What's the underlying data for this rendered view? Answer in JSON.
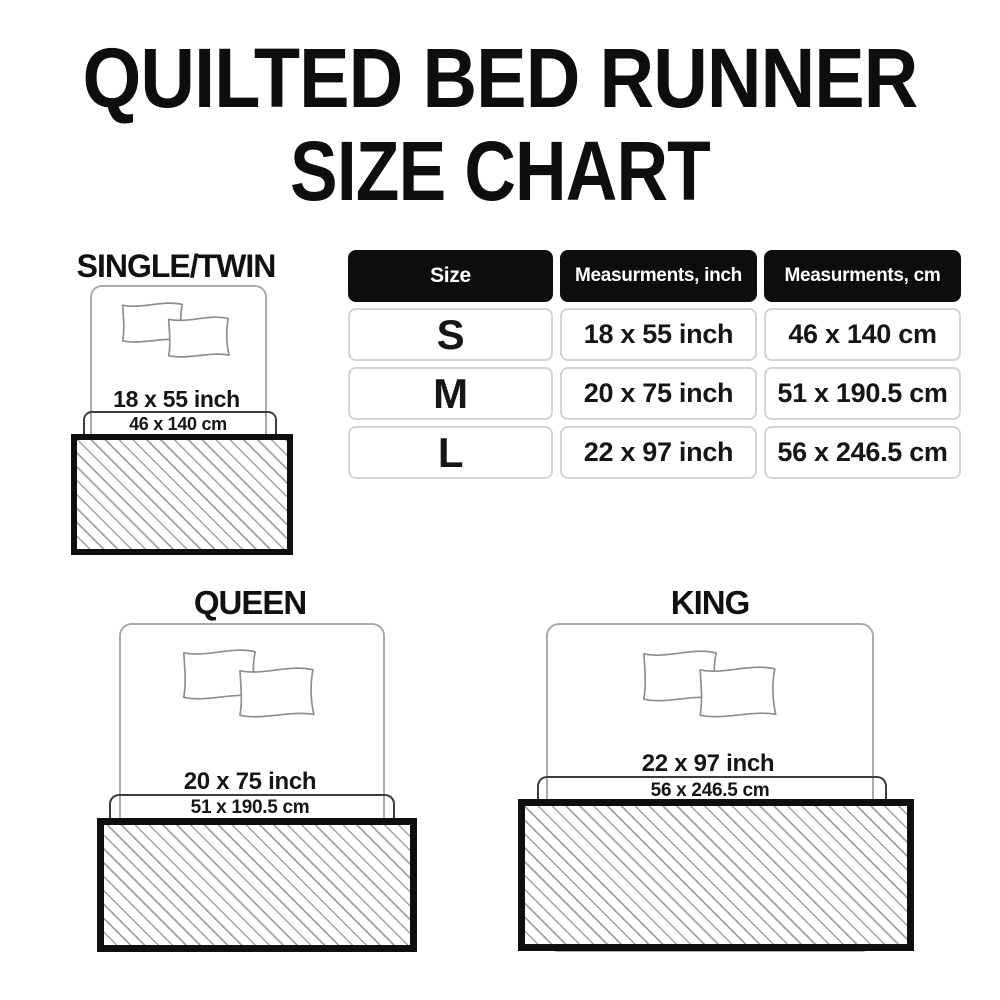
{
  "title": {
    "line1": "QUILTED BED RUNNER",
    "line2": "SIZE CHART"
  },
  "sections": {
    "single": {
      "label": "SINGLE/TWIN",
      "inch": "18 x 55 inch",
      "cm": "46 x 140 cm"
    },
    "queen": {
      "label": "QUEEN",
      "inch": "20 x 75 inch",
      "cm": "51 x 190.5 cm"
    },
    "king": {
      "label": "KING",
      "inch": "22 x 97 inch",
      "cm": "56 x 246.5 cm"
    }
  },
  "table": {
    "headers": [
      "Size",
      "Measurments, inch",
      "Measurments, cm"
    ],
    "rows": [
      {
        "size": "S",
        "inch": "18 x 55 inch",
        "cm": "46 x 140 cm"
      },
      {
        "size": "M",
        "inch": "20 x 75 inch",
        "cm": "51 x 190.5 cm"
      },
      {
        "size": "L",
        "inch": "22 x 97 inch",
        "cm": "56 x 246.5 cm"
      }
    ]
  },
  "colors": {
    "text": "#141414",
    "table_header_bg": "#0d0d0d",
    "table_header_text": "#ffffff",
    "table_cell_border": "#d4d4d4",
    "bed_outline": "#acacac",
    "pillow_outline": "#8f8f8f",
    "bracket_line": "#3d3d3d",
    "runner_border": "#0f0f0f",
    "runner_hatch": "#a3a3a3"
  }
}
